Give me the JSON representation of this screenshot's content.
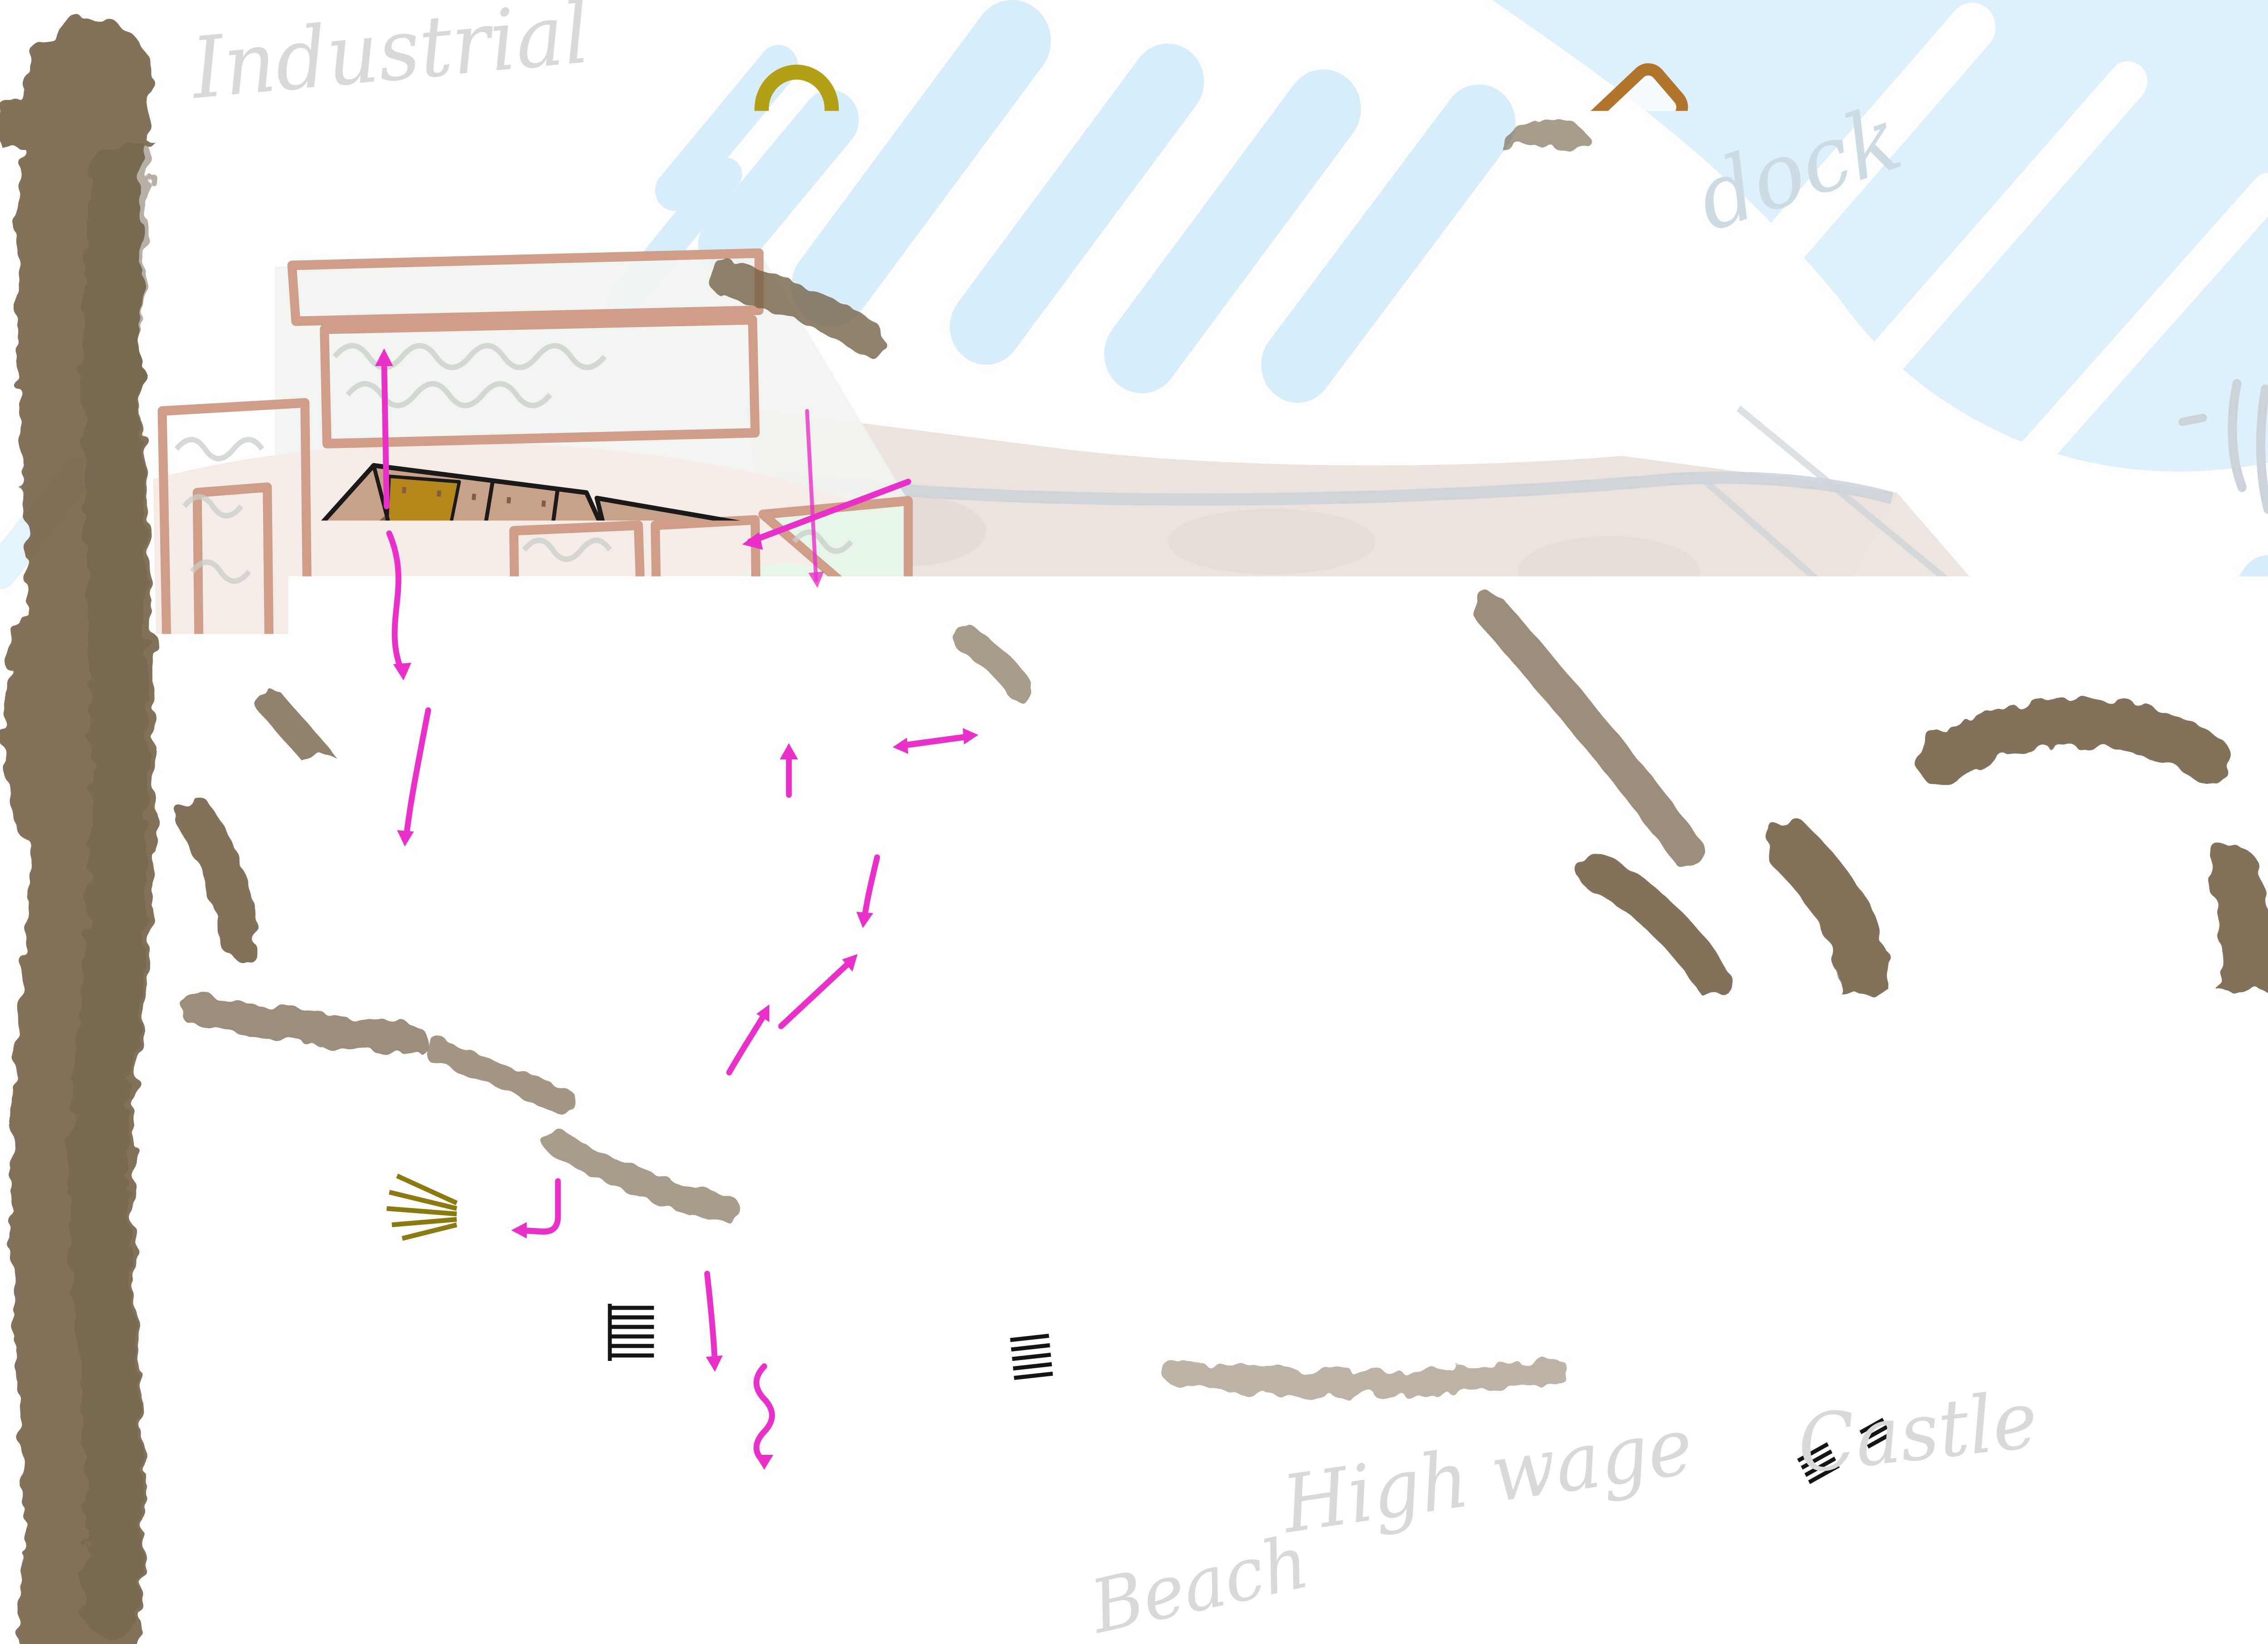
{
  "map": {
    "labels": [
      {
        "id": "industrial",
        "text": "Industrial"
      },
      {
        "id": "dock",
        "text": "dock"
      },
      {
        "id": "castle",
        "text": "Castle"
      },
      {
        "id": "high-wage",
        "text": "High wage"
      },
      {
        "id": "beach",
        "text": "Beach"
      }
    ],
    "palette": {
      "water": "#d8edfa",
      "forest": "#75634a",
      "city_wall_olive": "#b3a016",
      "old_town_roof": "#c8a189",
      "old_town_roof_mid": "#a17457",
      "old_town_roof_dark": "#8a5a40",
      "gold_accent": "#b5861b",
      "new_town_roof_light": "#ef9c60",
      "new_town_roof": "#e8823f",
      "new_town_roof_dark": "#c15f28",
      "courtyard_green": "#7cb956",
      "castle_roof_light": "#f4a071",
      "castle_roof_dark": "#bf5f2a",
      "courtyard_hatch_brown": "#9a6b42",
      "dock_brown": "#b0742c",
      "warehouse_gray": "#8a8a8a",
      "field_outline_rose": "#cf9d88",
      "arena_pink": "#f8ecf5",
      "arena_arc_brown": "#b96a33",
      "route_arrow_magenta": "#e930c9",
      "beach_cream": "#f8f4da",
      "label_gray": "#d9d9d9",
      "road_orange": "#c06727",
      "mint_green": "#e7f4e8"
    }
  }
}
